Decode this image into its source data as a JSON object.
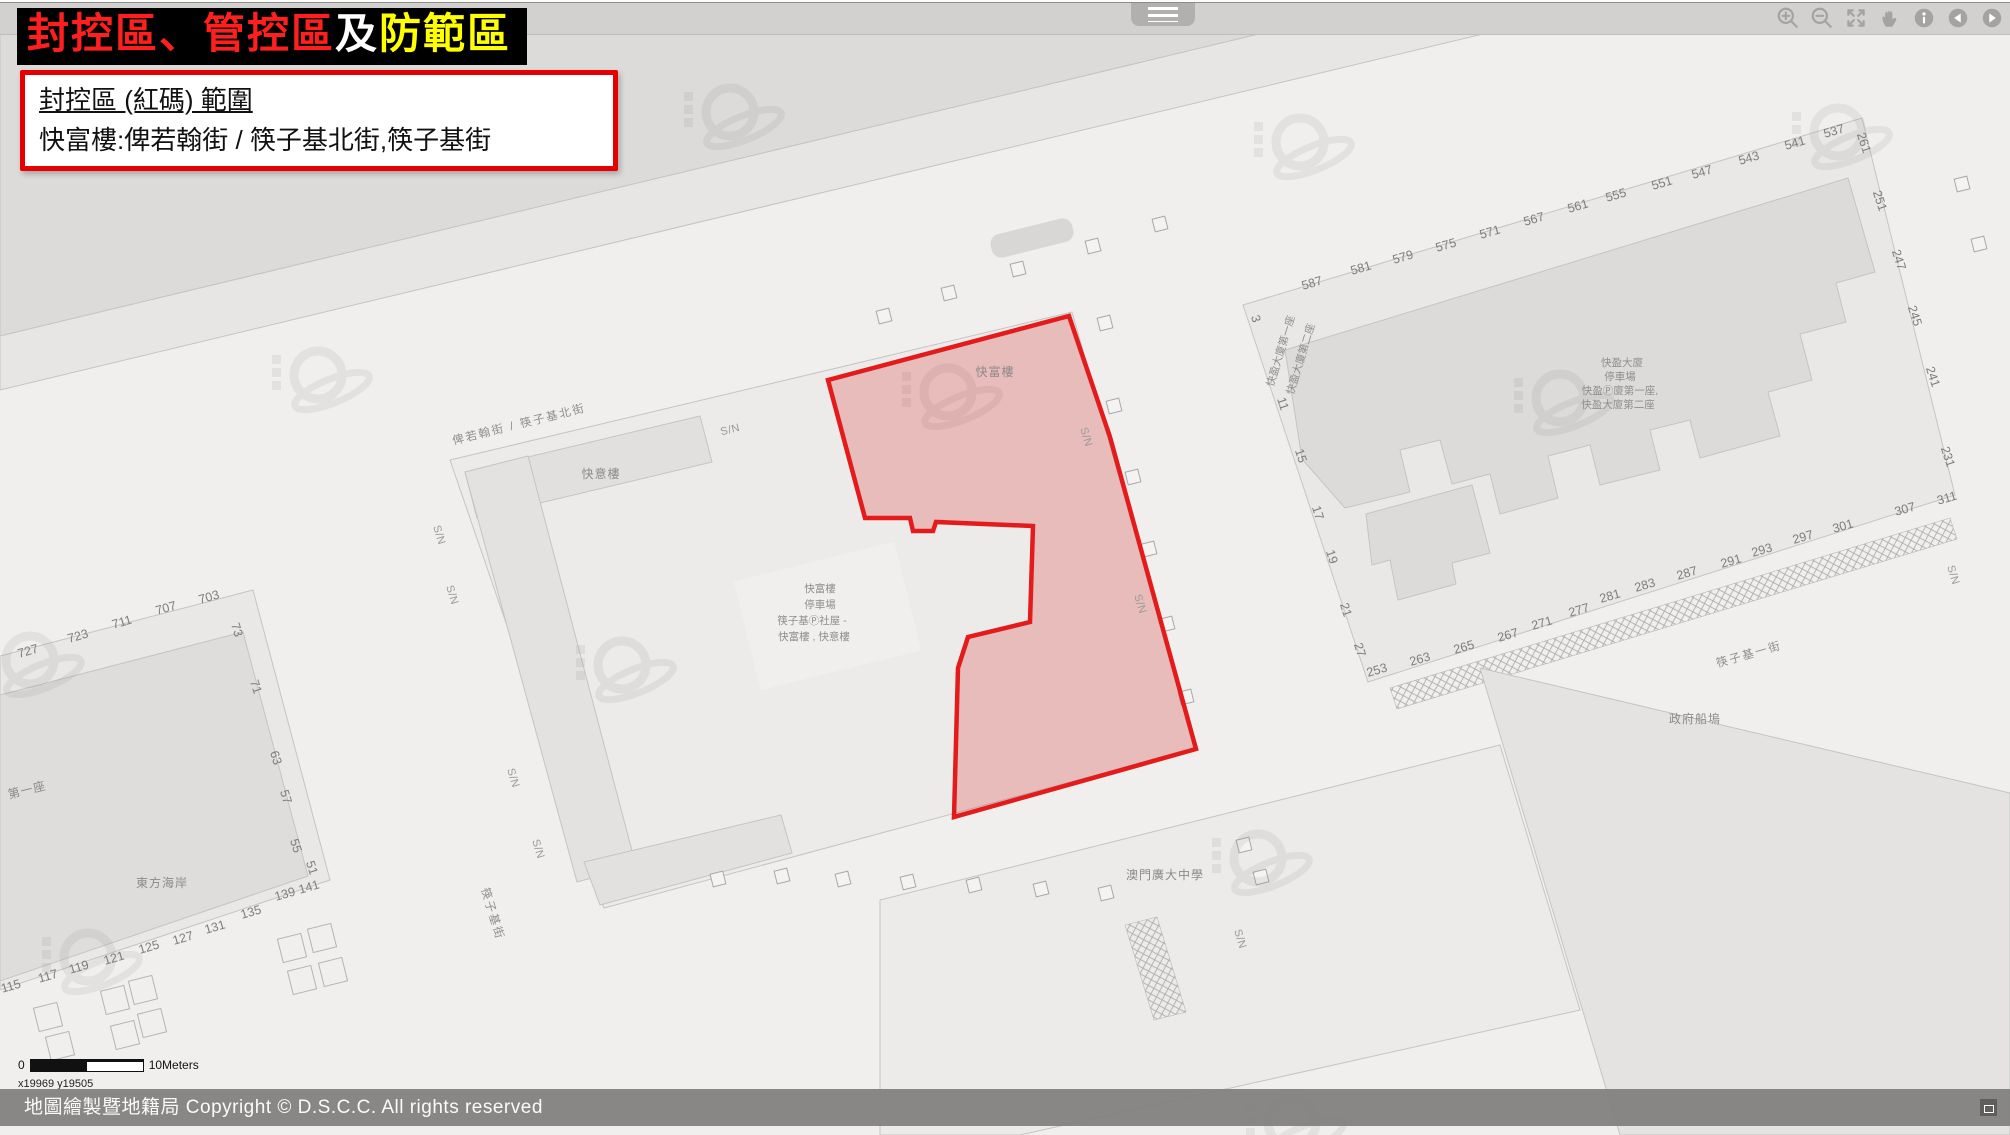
{
  "page_title": {
    "segments": [
      {
        "text": "封控區、管控區",
        "color": "#ff1f1f"
      },
      {
        "text": "及",
        "color": "#ffffff"
      },
      {
        "text": "防範區",
        "color": "#ffff00"
      }
    ]
  },
  "info_box": {
    "title": "封控區 (紅碼) 範圍",
    "detail": "快富樓:俾若翰街 / 筷子基北街,筷子基街"
  },
  "toolbar": {
    "icons": [
      "zoom-in",
      "zoom-out",
      "full-extent",
      "pan",
      "identify",
      "previous-extent",
      "next-extent"
    ]
  },
  "scale_bar": {
    "start": "0",
    "end": "10Meters"
  },
  "coordinates": "x19969 y19505",
  "footer": {
    "copyright": "地圖繪製暨地籍局 Copyright © D.S.C.C. All rights reserved"
  },
  "colors": {
    "zone_stroke": "#e31b1b",
    "zone_fill": "rgba(214,48,48,0.25)",
    "banner_bg": "#000000",
    "banner_red": "#ff1f1f",
    "banner_yellow": "#ffff00"
  },
  "map": {
    "texts": [
      {
        "t": "俾若翰街 / 筷子基北街",
        "x": 520,
        "y": 428,
        "r": -14,
        "k": "street"
      },
      {
        "t": "筷子基街",
        "x": 489,
        "y": 915,
        "r": 73,
        "k": "street"
      },
      {
        "t": "筷子基一街",
        "x": 1750,
        "y": 658,
        "r": -16,
        "k": "street"
      },
      {
        "t": "快富樓",
        "x": 995,
        "y": 376,
        "k": "name"
      },
      {
        "t": "快意樓",
        "x": 601,
        "y": 478,
        "k": "name"
      },
      {
        "t": "東方海岸",
        "x": 162,
        "y": 887,
        "k": "name"
      },
      {
        "t": "第一座",
        "x": 28,
        "y": 794,
        "r": -14,
        "k": "name"
      },
      {
        "t": "澳門廣大中學",
        "x": 1165,
        "y": 879,
        "k": "name"
      },
      {
        "t": "政府船塢",
        "x": 1695,
        "y": 723,
        "k": "name"
      },
      {
        "t": "快富樓",
        "x": 820,
        "y": 592,
        "k": "name-sm"
      },
      {
        "t": "停車場",
        "x": 820,
        "y": 608,
        "k": "name-sm"
      },
      {
        "t": "筷子基Ⓟ社屋 -",
        "x": 812,
        "y": 624,
        "k": "name-sm"
      },
      {
        "t": "快富樓 , 快意樓",
        "x": 814,
        "y": 640,
        "k": "name-sm"
      },
      {
        "t": "快盈大廈",
        "x": 1622,
        "y": 366,
        "k": "name-sm"
      },
      {
        "t": "停車場",
        "x": 1620,
        "y": 380,
        "k": "name-sm"
      },
      {
        "t": "快盈Ⓟ廈第一座,",
        "x": 1620,
        "y": 394,
        "k": "name-sm"
      },
      {
        "t": "快盈大廈第二座",
        "x": 1618,
        "y": 408,
        "k": "name-sm"
      },
      {
        "t": "快盈大廈第一座",
        "x": 1284,
        "y": 352,
        "r": -73,
        "k": "name-sm"
      },
      {
        "t": "快盈大廈第二座",
        "x": 1304,
        "y": 360,
        "r": -73,
        "k": "name-sm"
      },
      {
        "t": "S/N",
        "x": 731,
        "y": 433,
        "r": -14,
        "k": "sn"
      },
      {
        "t": "S/N",
        "x": 436,
        "y": 536,
        "r": 73,
        "k": "sn"
      },
      {
        "t": "S/N",
        "x": 449,
        "y": 596,
        "r": 73,
        "k": "sn"
      },
      {
        "t": "S/N",
        "x": 510,
        "y": 779,
        "r": 73,
        "k": "sn"
      },
      {
        "t": "S/N",
        "x": 535,
        "y": 850,
        "r": 73,
        "k": "sn"
      },
      {
        "t": "S/N",
        "x": 1083,
        "y": 438,
        "r": 73,
        "k": "sn"
      },
      {
        "t": "S/N",
        "x": 1137,
        "y": 605,
        "r": 73,
        "k": "sn"
      },
      {
        "t": "S/N",
        "x": 1237,
        "y": 940,
        "r": 73,
        "k": "sn"
      },
      {
        "t": "S/N",
        "x": 1950,
        "y": 576,
        "r": 73,
        "k": "sn"
      },
      {
        "t": "727",
        "x": 29,
        "y": 655,
        "r": -16
      },
      {
        "t": "723",
        "x": 79,
        "y": 640,
        "r": -16
      },
      {
        "t": "711",
        "x": 123,
        "y": 626,
        "r": -16
      },
      {
        "t": "707",
        "x": 167,
        "y": 612,
        "r": -16
      },
      {
        "t": "703",
        "x": 210,
        "y": 601,
        "r": -16
      },
      {
        "t": "73",
        "x": 233,
        "y": 631,
        "r": 72
      },
      {
        "t": "71",
        "x": 252,
        "y": 688,
        "r": 72
      },
      {
        "t": "63",
        "x": 272,
        "y": 759,
        "r": 72
      },
      {
        "t": "57",
        "x": 282,
        "y": 798,
        "r": 72
      },
      {
        "t": "55",
        "x": 292,
        "y": 847,
        "r": 72
      },
      {
        "t": "51",
        "x": 308,
        "y": 869,
        "r": 72
      },
      {
        "t": "141",
        "x": 310,
        "y": 891,
        "r": -16
      },
      {
        "t": "139",
        "x": 286,
        "y": 898,
        "r": -16
      },
      {
        "t": "135",
        "x": 252,
        "y": 916,
        "r": -16
      },
      {
        "t": "131",
        "x": 216,
        "y": 931,
        "r": -16
      },
      {
        "t": "127",
        "x": 184,
        "y": 942,
        "r": -16
      },
      {
        "t": "125",
        "x": 150,
        "y": 951,
        "r": -16
      },
      {
        "t": "121",
        "x": 115,
        "y": 962,
        "r": -16
      },
      {
        "t": "119",
        "x": 80,
        "y": 971,
        "r": -16
      },
      {
        "t": "117",
        "x": 49,
        "y": 980,
        "r": -16
      },
      {
        "t": "115",
        "x": 12,
        "y": 990,
        "r": -16
      },
      {
        "t": "587",
        "x": 1313,
        "y": 287,
        "r": -16
      },
      {
        "t": "581",
        "x": 1362,
        "y": 272,
        "r": -16
      },
      {
        "t": "579",
        "x": 1404,
        "y": 261,
        "r": -16
      },
      {
        "t": "575",
        "x": 1447,
        "y": 249,
        "r": -16
      },
      {
        "t": "571",
        "x": 1491,
        "y": 236,
        "r": -16
      },
      {
        "t": "567",
        "x": 1535,
        "y": 223,
        "r": -16
      },
      {
        "t": "561",
        "x": 1579,
        "y": 210,
        "r": -16
      },
      {
        "t": "555",
        "x": 1617,
        "y": 199,
        "r": -16
      },
      {
        "t": "551",
        "x": 1663,
        "y": 187,
        "r": -16
      },
      {
        "t": "547",
        "x": 1703,
        "y": 176,
        "r": -16
      },
      {
        "t": "543",
        "x": 1750,
        "y": 162,
        "r": -16
      },
      {
        "t": "541",
        "x": 1796,
        "y": 147,
        "r": -16
      },
      {
        "t": "537",
        "x": 1835,
        "y": 135,
        "r": -16
      },
      {
        "t": "261",
        "x": 1860,
        "y": 144,
        "r": 72
      },
      {
        "t": "251",
        "x": 1876,
        "y": 202,
        "r": 72
      },
      {
        "t": "247",
        "x": 1895,
        "y": 261,
        "r": 72
      },
      {
        "t": "245",
        "x": 1911,
        "y": 317,
        "r": 72
      },
      {
        "t": "241",
        "x": 1929,
        "y": 378,
        "r": 72
      },
      {
        "t": "231",
        "x": 1944,
        "y": 458,
        "r": 72
      },
      {
        "t": "3",
        "x": 1252,
        "y": 320,
        "r": 72
      },
      {
        "t": "11",
        "x": 1279,
        "y": 405,
        "r": 72
      },
      {
        "t": "15",
        "x": 1297,
        "y": 457,
        "r": 72
      },
      {
        "t": "17",
        "x": 1314,
        "y": 514,
        "r": 72
      },
      {
        "t": "19",
        "x": 1328,
        "y": 558,
        "r": 72
      },
      {
        "t": "21",
        "x": 1342,
        "y": 611,
        "r": 72
      },
      {
        "t": "27",
        "x": 1356,
        "y": 651,
        "r": 72
      },
      {
        "t": "253",
        "x": 1378,
        "y": 674,
        "r": -16
      },
      {
        "t": "263",
        "x": 1421,
        "y": 663,
        "r": -16
      },
      {
        "t": "265",
        "x": 1465,
        "y": 651,
        "r": -16
      },
      {
        "t": "267",
        "x": 1509,
        "y": 639,
        "r": -16
      },
      {
        "t": "271",
        "x": 1543,
        "y": 627,
        "r": -16
      },
      {
        "t": "277",
        "x": 1580,
        "y": 614,
        "r": -16
      },
      {
        "t": "281",
        "x": 1611,
        "y": 600,
        "r": -16
      },
      {
        "t": "283",
        "x": 1646,
        "y": 589,
        "r": -16
      },
      {
        "t": "287",
        "x": 1688,
        "y": 577,
        "r": -16
      },
      {
        "t": "291",
        "x": 1732,
        "y": 565,
        "r": -16
      },
      {
        "t": "293",
        "x": 1763,
        "y": 554,
        "r": -16
      },
      {
        "t": "297",
        "x": 1804,
        "y": 541,
        "r": -16
      },
      {
        "t": "301",
        "x": 1844,
        "y": 530,
        "r": -16
      },
      {
        "t": "307",
        "x": 1906,
        "y": 513,
        "r": -16
      },
      {
        "t": "311",
        "x": 1948,
        "y": 502,
        "r": -16
      }
    ]
  }
}
